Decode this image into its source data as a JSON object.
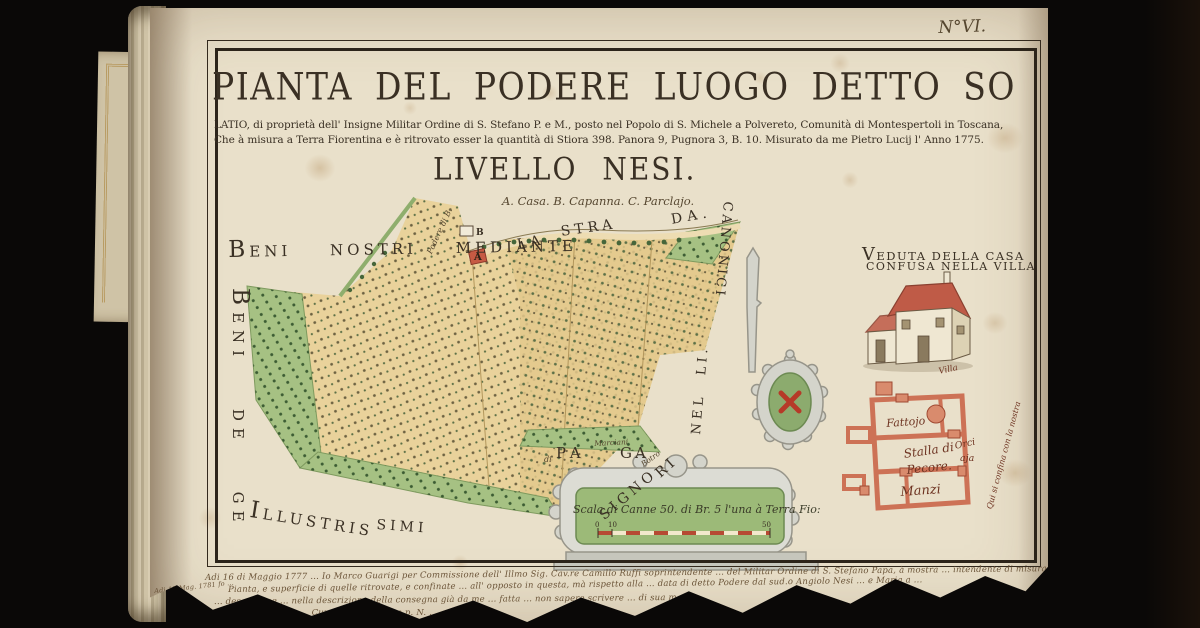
{
  "page_label": "N°VI.",
  "title_block": {
    "title_line1": "PIANTA DEL PODERE LUOGO DETTO SO",
    "title_line2": "LATIO, di proprietà dell' Insigne Militar Ordine di S. Stefano P. e M., posto nel Popolo di S. Michele a Polvereto, Comunità di Montespertoli in Toscana,",
    "title_line3": "Che à misura a Terra Fiorentina e è ritrovato esser la quantità di Stiora 398. Panora 9, Pugnora 3, B. 10. Misurato da me Pietro Lucij l' Anno 1775.",
    "subtitle": "LIVELLO NESI.",
    "legend": "A. Casa. B. Capanna. C. Parclajo."
  },
  "border_labels": {
    "beni_nostri": "BENI NOSTRI MEDIANTE",
    "beni_de_ge": "BENI DE GE",
    "la": "LA",
    "stra": "STRA",
    "da": "DA.",
    "canonici": "CANONICI",
    "nelli": "NEL LI.",
    "illustris": "ILLUSTRIS",
    "simi": "SIMI",
    "signo": "SIGNO",
    "ri": "RI",
    "botro": "Botro",
    "di": "di",
    "pa": "PA",
    "marciani": "Marciani",
    "ga": "GA",
    "podere": "Podere di B.",
    "marker_a": "A",
    "marker_b": "B"
  },
  "veduta": {
    "caption1": "VEDUTA DELLA CASA",
    "caption2": "CONFUSA NELLA VILLA"
  },
  "floor_plan": {
    "fattojo": "Fattojo",
    "stalla": "Stalla di",
    "pecore": "Pecore.",
    "orci": "Orci",
    "aja": "aja",
    "manzi": "Manzi",
    "villa": "Villa",
    "confine": "Qui si confina con la nostra"
  },
  "scale_bar": {
    "caption": "Scala di Canne 50. di Br. 5 l'una à Terra Fio:",
    "tick0": "0",
    "tick10": "10",
    "tick50": "50"
  },
  "manuscript": {
    "line1": "Adi 16 di Maggio 1777 ... Io Marco Guarigi per Commissione dell' Illmo Sig. Cav.re Camillo Ruffi soprintendente ... del Militar Ordine di S. Stefano Papa, à mostra ... intendente di misura, alla delineata colorazione ... ed alla",
    "line2": "Pianta, e superficie di quelle ritrovate, e confinate ... all' opposto in questa, mà rispetto alla ... data di detto Podere dal sud.o Angiolo Nesi ... e Maria a ...",
    "line3": "... descrizione ... nella descrizione della consegna già da me ... fatta ... non sapere scrivere ... di sua mano ...",
    "line4": "... Curato ... di d.a ... e p. N. ...",
    "marginal": "Adi 12 Mag. 1781 fo ..."
  },
  "colors": {
    "bg": "#0a0807",
    "page": "#e9e0ca",
    "ink": "#3a3024",
    "ink-light": "#55462f",
    "tan": "#e9d29b",
    "tan2": "#e3c98c",
    "green": "#a6c183",
    "green-dark": "#46663a",
    "gray": "#d4d4cb",
    "gray-line": "#97958a",
    "roof-red": "#bf5b47",
    "plan-pink": "#cd7256",
    "plan-fill": "#d98b6d",
    "crest-green": "#8cab6e",
    "cross-red": "#b63a28",
    "manuscript-ink": "#6b5438"
  }
}
